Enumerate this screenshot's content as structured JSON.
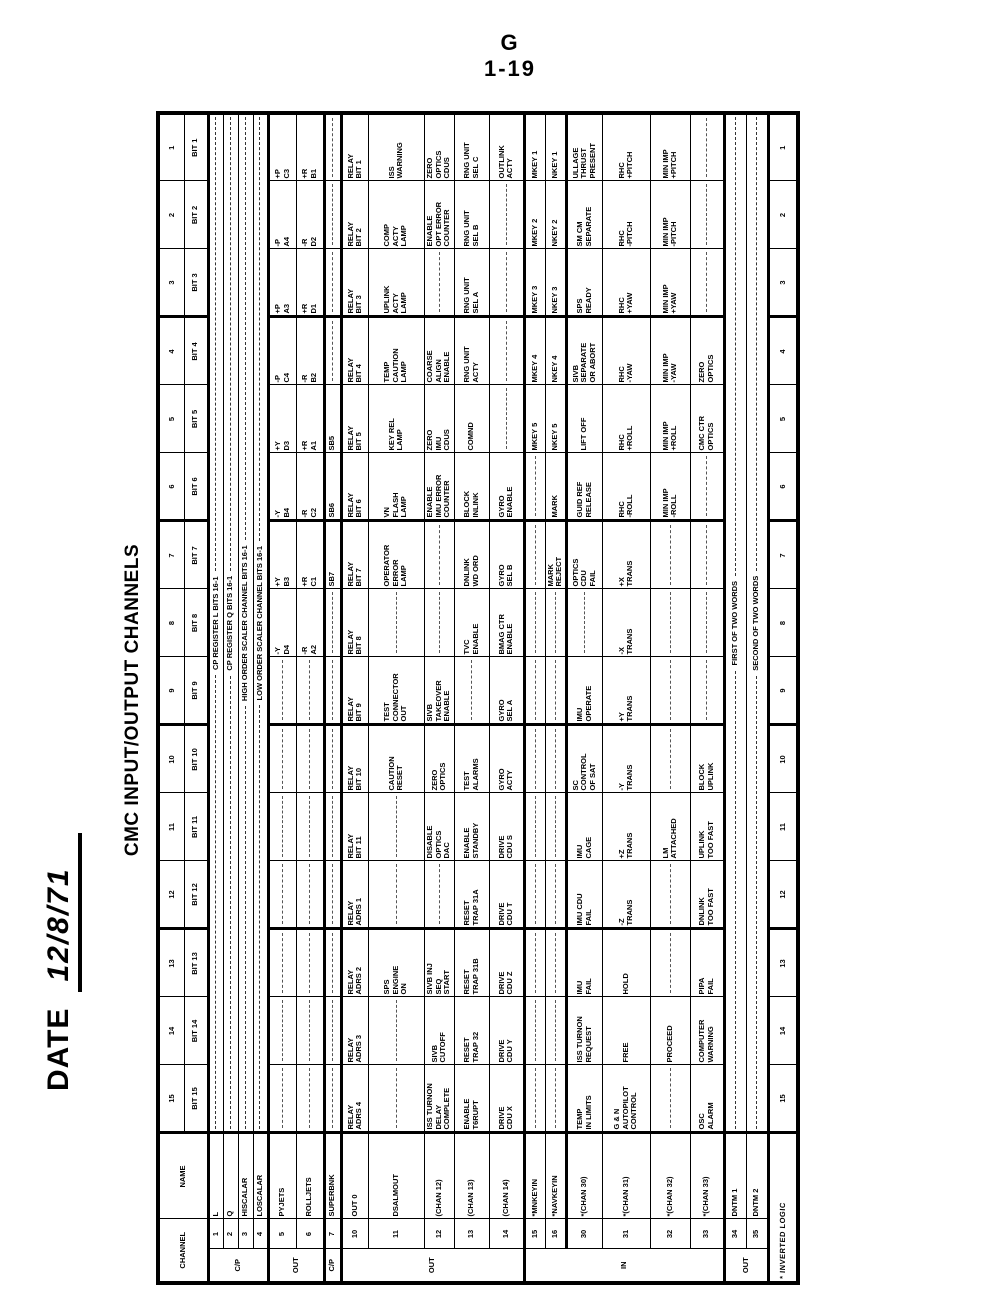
{
  "page": {
    "folio_line1": "G",
    "folio_line2": "1-19",
    "date_label": "DATE",
    "date_value": "12/8/71",
    "title": "CMC INPUT/OUTPUT CHANNELS"
  },
  "table": {
    "header": {
      "channel": "CHANNEL",
      "name": "NAME",
      "bit_prefix": "BIT"
    },
    "column_numbers": [
      15,
      14,
      13,
      12,
      11,
      10,
      9,
      8,
      7,
      6,
      5,
      4,
      3,
      2,
      1
    ],
    "footnote": "* INVERTED LOGIC",
    "groups": [
      {
        "label": "C/P",
        "span": 4
      },
      {
        "label": "OUT",
        "span": 2
      },
      {
        "label": "C/P",
        "span": 1
      },
      {
        "label": "OUT",
        "span": 5
      },
      {
        "label": "IN",
        "span": 6
      },
      {
        "label": "OUT",
        "span": 2
      }
    ],
    "rows": [
      {
        "ch": "1",
        "name": "L",
        "merged": "CP REGISTER L   BITS 16-1"
      },
      {
        "ch": "2",
        "name": "Q",
        "merged": "CP REGISTER Q   BITS 16-1"
      },
      {
        "ch": "3",
        "name": "HISCALAR",
        "merged": "HIGH ORDER SCALER CHANNEL   BITS 16-1"
      },
      {
        "ch": "4",
        "name": "LOSCALAR",
        "merged": "LOW ORDER SCALER CHANNEL   BITS 16-1"
      },
      {
        "ch": "5",
        "name": "PYJETS",
        "bits": {
          "1": "+P\nC3",
          "2": "-P\nA4",
          "3": "+P\nA3",
          "4": "-P\nC4",
          "5": "+Y\nD3",
          "6": "-Y\nB4",
          "7": "+Y\nB3",
          "8": "-Y\nD4"
        }
      },
      {
        "ch": "6",
        "name": "ROLLJETS",
        "bits": {
          "1": "+R\nB1",
          "2": "-R\nD2",
          "3": "+R\nD1",
          "4": "-R\nB2",
          "5": "+R\nA1",
          "6": "-R\nC2",
          "7": "+R\nC1",
          "8": "-R\nA2"
        }
      },
      {
        "ch": "7",
        "name": "SUPERBNK",
        "bits": {
          "5": "SB5",
          "6": "SB6",
          "7": "SB7"
        }
      },
      {
        "ch": "10",
        "name": "OUT 0",
        "bits": {
          "1": "RELAY\nBIT 1",
          "2": "RELAY\nBIT 2",
          "3": "RELAY\nBIT 3",
          "4": "RELAY\nBIT 4",
          "5": "RELAY\nBIT 5",
          "6": "RELAY\nBIT 6",
          "7": "RELAY\nBIT 7",
          "8": "RELAY\nBIT 8",
          "9": "RELAY\nBIT 9",
          "10": "RELAY\nBIT 10",
          "11": "RELAY\nBIT 11",
          "12": "RELAY\nADRS 1",
          "13": "RELAY\nADRS 2",
          "14": "RELAY\nADRS 3",
          "15": "RELAY\nADRS 4"
        }
      },
      {
        "ch": "11",
        "name": "DSALMOUT",
        "bits": {
          "1": "ISS\nWARNING",
          "2": "COMP\nACTY\nLAMP",
          "3": "UPLINK\nACTY\nLAMP",
          "4": "TEMP\nCAUTION\nLAMP",
          "5": "KEY REL\nLAMP",
          "6": "VN\nFLASH\nLAMP",
          "7": "OPERATOR\nERROR\nLAMP",
          "9": "TEST\nCONNECTOR\nOUT",
          "10": "CAUTION\nRESET",
          "13": "SPS\nENGINE\nON"
        }
      },
      {
        "ch": "12",
        "name": "(CHAN 12)",
        "bits": {
          "1": "ZERO\nOPTICS\nCDUS",
          "2": "ENABLE\nOPT ERROR\nCOUNTER",
          "4": "COARSE\nALIGN\nENABLE",
          "5": "ZERO\nIMU\nCDUS",
          "6": "ENABLE\nIMU ERROR\nCOUNTER",
          "9": "SIVB\nTAKEOVER\nENABLE",
          "10": "ZERO\nOPTICS",
          "11": "DISABLE\nOPTICS\nDAC",
          "13": "SIVB INJ\nSEQ\nSTART",
          "14": "SIVB\nCUTOFF",
          "15": "ISS TURNON\nDELAY\nCOMPLETE"
        }
      },
      {
        "ch": "13",
        "name": "(CHAN 13)",
        "bits": {
          "1": "RNG UNIT\nSEL C",
          "2": "RNG UNIT\nSEL B",
          "3": "RNG UNIT\nSEL A",
          "4": "RNG UNIT\nACTY",
          "5": "COMND",
          "6": "BLOCK\nINLINK",
          "7": "DNLINK\nWD ORD",
          "8": "TVC\nENABLE",
          "10": "TEST\nALARMS",
          "11": "ENABLE\nSTANDBY",
          "12": "RESET\nTRAP 31A",
          "13": "RESET\nTRAP 31B",
          "14": "RESET\nTRAP 32",
          "15": "ENABLE\nT6RUPT"
        }
      },
      {
        "ch": "14",
        "name": "(CHAN 14)",
        "bits": {
          "1": "OUTLINK\nACTY",
          "6": "GYRO\nENABLE",
          "7": "GYRO\nSEL B",
          "8": "BMAG CTR\nENABLE",
          "9": "GYRO\nSEL A",
          "10": "GYRO\nACTY",
          "11": "DRIVE\nCDU S",
          "12": "DRIVE\nCDU T",
          "13": "DRIVE\nCDU Z",
          "14": "DRIVE\nCDU Y",
          "15": "DRIVE\nCDU X"
        }
      },
      {
        "ch": "15",
        "name": "*MNKEYIN",
        "bits": {
          "1": "MKEY 1",
          "2": "MKEY 2",
          "3": "MKEY 3",
          "4": "MKEY 4",
          "5": "MKEY 5"
        }
      },
      {
        "ch": "16",
        "name": "*NAVKEYIN",
        "bits": {
          "1": "NKEY 1",
          "2": "NKEY 2",
          "3": "NKEY 3",
          "4": "NKEY 4",
          "5": "NKEY 5",
          "6": "MARK",
          "7": "MARK\nREJECT"
        }
      },
      {
        "ch": "30",
        "name": "*(CHAN 30)",
        "bits": {
          "1": "ULLAGE\nTHRUST\nPRESENT",
          "2": "SM CM\nSEPARATE",
          "3": "SPS\nREADY",
          "4": "SIVB\nSEPARATE\nOR ABORT",
          "5": "LIFT OFF",
          "6": "GUID REF\nRELEASE",
          "7": "OPTICS\nCDU\nFAIL",
          "9": "IMU\nOPERATE",
          "10": "SC\nCONTROL\nOF SAT",
          "11": "IMU\nCAGE",
          "12": "IMU CDU\nFAIL",
          "13": "IMU\nFAIL",
          "14": "ISS TURNON\nREQUEST",
          "15": "TEMP\nIN LIMITS"
        }
      },
      {
        "ch": "31",
        "name": "*(CHAN 31)",
        "bits": {
          "1": "RHC\n+PITCH",
          "2": "RHC\n-PITCH",
          "3": "RHC\n+YAW",
          "4": "RHC\n-YAW",
          "5": "RHC\n+ROLL",
          "6": "RHC\n-ROLL",
          "7": "+X\nTRANS",
          "8": "-X\nTRANS",
          "9": "+Y\nTRANS",
          "10": "-Y\nTRANS",
          "11": "+Z\nTRANS",
          "12": "-Z\nTRANS",
          "13": "HOLD",
          "14": "FREE",
          "15": "G & N\nAUTOPILOT\nCONTROL"
        }
      },
      {
        "ch": "32",
        "name": "*(CHAN 32)",
        "bits": {
          "1": "MIN IMP\n+PITCH",
          "2": "MIN IMP\n-PITCH",
          "3": "MIN IMP\n+YAW",
          "4": "MIN IMP\n-YAW",
          "5": "MIN IMP\n+ROLL",
          "6": "MIN IMP\n-ROLL",
          "11": "LM\nATTACHED",
          "14": "PROCEED"
        }
      },
      {
        "ch": "33",
        "name": "*(CHAN 33)",
        "bits": {
          "4": "ZERO\nOPTICS",
          "5": "CMC CTR\nOPTICS",
          "10": "BLOCK\nUPLINK",
          "11": "UPLINK\nTOO FAST",
          "12": "DNLINK\nTOO FAST",
          "13": "PIPA\nFAIL",
          "14": "COMPUTER\nWARNING",
          "15": "OSC\nALARM"
        }
      },
      {
        "ch": "34",
        "name": "DNTM 1",
        "merged": "FIRST OF TWO WORDS"
      },
      {
        "ch": "35",
        "name": "DNTM 2",
        "merged": "SECOND OF TWO WORDS"
      }
    ]
  }
}
